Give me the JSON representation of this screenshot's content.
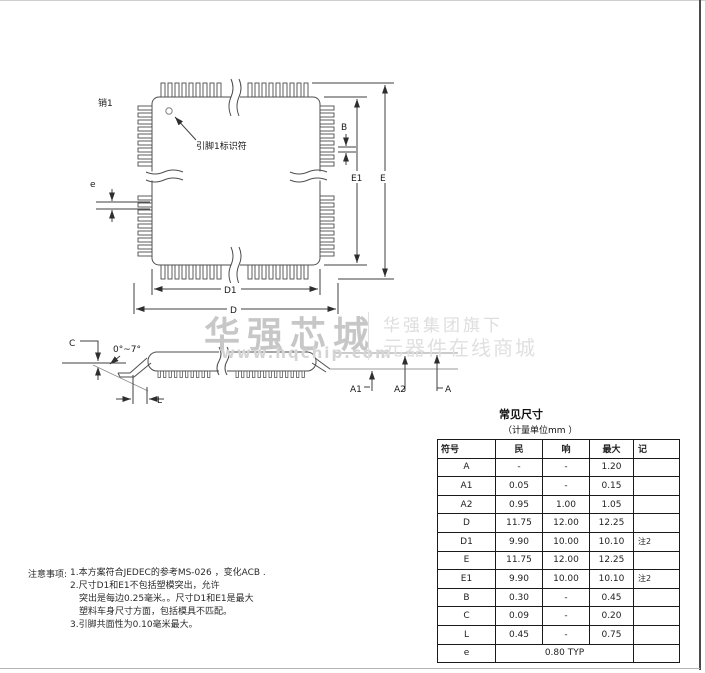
{
  "watermark": {
    "brand": "华强芯城",
    "url": "www.hqchip.com",
    "tagline_line1": "华强集团旗下",
    "tagline_line2": "元器件在线商城"
  },
  "top_view": {
    "pin1_label": "销1",
    "pin1_identifier": "引脚1标识符",
    "labels": {
      "e": "e",
      "B": "B",
      "E1": "E1",
      "E": "E",
      "D1": "D1",
      "D": "D"
    }
  },
  "side_view": {
    "labels": {
      "C": "C",
      "angle": "0°~7°",
      "L": "L",
      "A1": "A1",
      "A2": "A2",
      "A": "A"
    }
  },
  "table": {
    "title": "常见尺寸",
    "unit_note": "（计量单位mm ）",
    "headers": [
      "符号",
      "民",
      "响",
      "最大",
      "记"
    ],
    "rows": [
      [
        "A",
        "-",
        "-",
        "1.20",
        ""
      ],
      [
        "A1",
        "0.05",
        "-",
        "0.15",
        ""
      ],
      [
        "A2",
        "0.95",
        "1.00",
        "1.05",
        ""
      ],
      [
        "D",
        "11.75",
        "12.00",
        "12.25",
        ""
      ],
      [
        "D1",
        "9.90",
        "10.00",
        "10.10",
        "注2"
      ],
      [
        "E",
        "11.75",
        "12.00",
        "12.25",
        ""
      ],
      [
        "E1",
        "9.90",
        "10.00",
        "10.10",
        "注2"
      ],
      [
        "B",
        "0.30",
        "-",
        "0.45",
        ""
      ],
      [
        "C",
        "0.09",
        "-",
        "0.20",
        ""
      ],
      [
        "L",
        "0.45",
        "-",
        "0.75",
        ""
      ]
    ],
    "span_row": {
      "symbol": "e",
      "value": "0.80 TYP",
      "note": ""
    }
  },
  "notes": {
    "label": "注意事项:",
    "lines": [
      {
        "text": "1.本方案符合JEDEC的参考MS-026 ，变化ACB .",
        "indent": false
      },
      {
        "text": "2.尺寸D1和E1不包括塑模突出，允许",
        "indent": false
      },
      {
        "text": "突出是每边0.25毫米。。尺寸D1和E1是最大",
        "indent": true
      },
      {
        "text": "塑料车身尺寸方面，包括模具不匹配。",
        "indent": true
      },
      {
        "text": "3.引脚共面性为0.10毫米最大。",
        "indent": false
      }
    ]
  }
}
